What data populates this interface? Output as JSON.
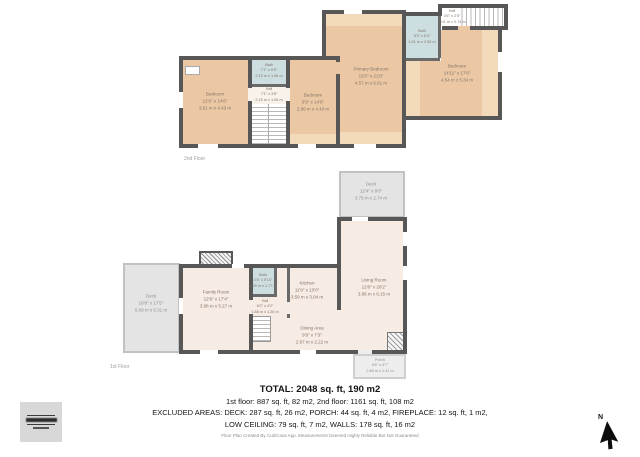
{
  "floor2": {
    "label": "2nd Floor",
    "rooms": {
      "bedroom_left": {
        "name": "Bedroom",
        "ft": "12'6\" x 14'6\"",
        "m": "3.81 m x 4.43 m"
      },
      "bath": {
        "name": "Bath",
        "ft": "7'1\" x 6'5\"",
        "m": "2.15 m x 1.96 m"
      },
      "hall": {
        "name": "Hall",
        "ft": "7'1\" x 3'6\"",
        "m": "2.15 m x 1.06 m"
      },
      "bedroom_mid": {
        "name": "Bedroom",
        "ft": "9'9\" x 14'6\"",
        "m": "2.96 m x 4.43 m"
      },
      "primary": {
        "name": "Primary Bedroom",
        "ft": "15'0\" x 21'8\"",
        "m": "4.57 m x 6.61 m"
      },
      "bath_tr": {
        "name": "Bath",
        "ft": "6'3\" x 8'3\"",
        "m": "1.91 m x 2.50 m"
      },
      "hall_tr": {
        "name": "Hall",
        "ft": "3'4\" x 2'5\"",
        "m": "1.01 m x 0.74 m"
      },
      "bedroom_right": {
        "name": "Bedroom",
        "ft": "14'11\" x 17'6\"",
        "m": "4.54 m x 5.34 m"
      }
    }
  },
  "floor1": {
    "label": "1st Floor",
    "rooms": {
      "deck_left": {
        "name": "Deck",
        "ft": "16'8\" x 17'5\"",
        "m": "5.09 m x 5.31 m"
      },
      "family_room": {
        "name": "Family Room",
        "ft": "12'9\" x 17'4\"",
        "m": "3.88 m x 5.27 m"
      },
      "bath": {
        "name": "Bath",
        "ft": "4'4\" x 5'10\"",
        "m": "0.99 m x 1.77 m"
      },
      "hall": {
        "name": "Hall",
        "ft": "6'2\" x 4'2\"",
        "m": "1.88 m x 1.26 m"
      },
      "kitchen": {
        "name": "Kitchen",
        "ft": "11'9\" x 10'0\"",
        "m": "3.59 m x 3.04 m"
      },
      "dining": {
        "name": "Dining Area",
        "ft": "9'9\" x 7'3\"",
        "m": "2.97 m x 2.22 m"
      },
      "living": {
        "name": "Living Room",
        "ft": "12'8\" x 20'2\"",
        "m": "3.86 m x 6.15 m"
      },
      "deck_top": {
        "name": "Deck",
        "ft": "12'4\" x 9'0\"",
        "m": "3.75 m x 2.74 m"
      },
      "porch": {
        "name": "Porch",
        "ft": "9'6\" x 4'7\"",
        "m": "2.89 m x 1.41 m"
      }
    }
  },
  "summary": {
    "total": "TOTAL: 2048 sq. ft, 190 m2",
    "floors": "1st floor: 887 sq. ft, 82 m2, 2nd floor: 1161 sq. ft, 108 m2",
    "excluded_1": "EXCLUDED AREAS: DECK: 287 sq. ft, 26 m2, PORCH: 44 sq. ft, 4 m2, FIREPLACE: 12 sq. ft, 1 m2,",
    "excluded_2": "LOW CEILING: 79 sq. ft, 7 m2, WALLS: 178 sq. ft, 16 m2",
    "disclaimer": "Floor Plan Created By CubiCasa App. Measurements Deemed Highly Reliable But Not Guaranteed"
  },
  "compass": {
    "label": "N"
  },
  "colors": {
    "wall": "#575757",
    "bedroom_floor": "#ebc8a3",
    "low_ceiling": "#f2dabb",
    "bath_floor": "#cddee1",
    "main_floor": "#f6ece4",
    "deck_floor": "#e4e4e4"
  }
}
